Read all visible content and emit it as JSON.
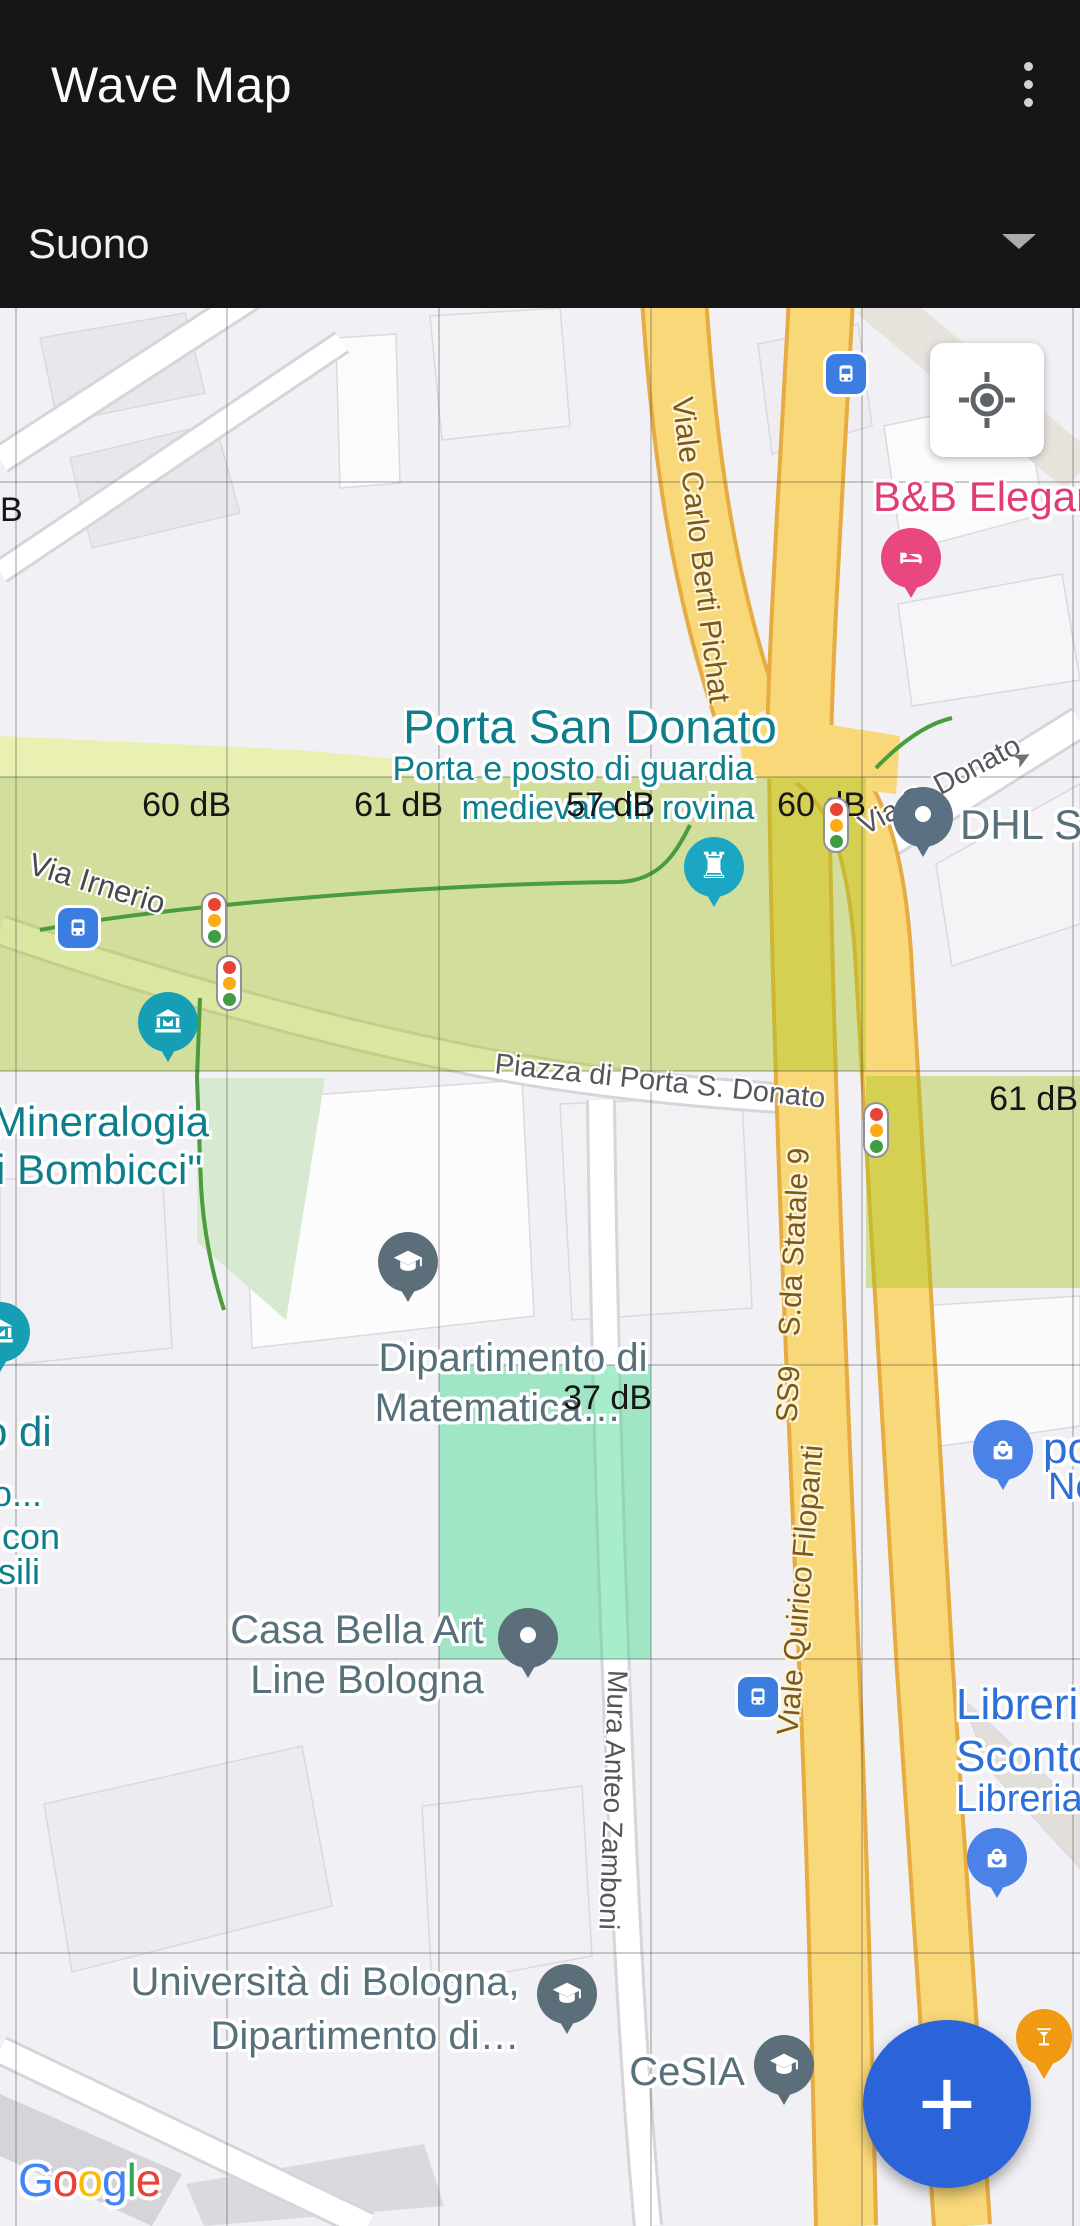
{
  "app_bar": {
    "title": "Wave Map",
    "menu_icon": "kebab-vertical-icon"
  },
  "layer_selector": {
    "value": "Suono",
    "caret_icon": "caret-down-icon",
    "caret_glyph": "▼"
  },
  "map": {
    "type": "google-map",
    "attribution": [
      {
        "ch": "G",
        "color": "#4285F4"
      },
      {
        "ch": "o",
        "color": "#EA4335"
      },
      {
        "ch": "o",
        "color": "#FBBC05"
      },
      {
        "ch": "g",
        "color": "#4285F4"
      },
      {
        "ch": "l",
        "color": "#34A853"
      },
      {
        "ch": "e",
        "color": "#EA4335"
      }
    ],
    "controls": {
      "my_location_icon": "crosshair-icon",
      "fab_icon": "plus-icon",
      "fab_glyph": "+"
    },
    "db_values": [
      60,
      61,
      57,
      60,
      61,
      37
    ],
    "db_labels": [
      {
        "text": "B"
      },
      {
        "text": "60 dB"
      },
      {
        "text": "61 dB"
      },
      {
        "text": "57 dB"
      },
      {
        "text": "60 dB"
      },
      {
        "text": "61 dB"
      },
      {
        "text": "37 dB"
      }
    ],
    "poi_labels": {
      "porta_san_donato": "Porta San Donato",
      "porta_sub_1": "Porta e posto di guardia",
      "porta_sub_2": "medievale in rovina",
      "mineralogia_1": "Mineralogia",
      "mineralogia_2": "i Bombicci\"",
      "museo_cut_1": "o di",
      "museo_cut_2": "o...",
      "museo_cut_3": "con",
      "museo_cut_4": "sili",
      "dhl": "DHL ST",
      "dipartimento_1": "Dipartimento di",
      "dipartimento_2": "Matematica…",
      "casa_1": "Casa Bella Art",
      "casa_2": "Line Bologna",
      "universita_1": "Università di Bologna,",
      "universita_2": "Dipartimento di…",
      "cesia": "CeSIA",
      "bnb": "B&B Elegan",
      "shop_cut_1": "po",
      "shop_cut_2": "Ne",
      "libreria_1": "Libreria",
      "libreria_2": "Sconto",
      "libreria_3": "Libreria"
    },
    "road_labels": {
      "berti_pichat": "Viale Carlo Berti Pichat",
      "via_s_donato": "Via S. Donato",
      "statale": "S.da Statale 9",
      "ss9": "SS9",
      "filopanti": "Viale Quirico Filopanti",
      "zamboni": "Mura Anteo Zamboni",
      "irnerio": "Via Irnerio",
      "piazza": "Piazza di Porta S. Donato"
    },
    "pins": [
      {
        "name": "hotel-pin",
        "icon": "bed-icon",
        "color": "#E8487F"
      },
      {
        "name": "dhl-pin",
        "icon": "dot-pin-icon",
        "color": "#5B7083"
      },
      {
        "name": "porta-tower-pin",
        "icon": "rook-icon",
        "glyph": "♜",
        "color": "#1BA7C4"
      },
      {
        "name": "museum-pin",
        "icon": "museum-icon",
        "color": "#169FB4"
      },
      {
        "name": "museum-pin-partial",
        "icon": "museum-icon",
        "color": "#169FB4"
      },
      {
        "name": "university-pin-matematica",
        "icon": "graduation-cap-icon",
        "color": "#5B6E79"
      },
      {
        "name": "casa-bella-pin",
        "icon": "dot-pin-icon",
        "color": "#5B6E79"
      },
      {
        "name": "shopping-pin",
        "icon": "shopping-bag-icon",
        "color": "#4A82E8"
      },
      {
        "name": "libreria-pin",
        "icon": "shopping-bag-icon",
        "color": "#4A82E8"
      },
      {
        "name": "university-pin-unibo",
        "icon": "graduation-cap-icon",
        "color": "#5B6E79"
      },
      {
        "name": "university-pin-cesia",
        "icon": "graduation-cap-icon",
        "color": "#5B6E79"
      },
      {
        "name": "cocktail-pin",
        "icon": "martini-icon",
        "color": "#F09A14"
      }
    ],
    "colors": {
      "header_bg": "#161616",
      "accent_fab": "#2B63D9",
      "db_cell_yellow": "#DCEA9B",
      "db_cell_mint": "#A8EEC9",
      "poi_teal": "#0E7D8C",
      "poi_slate": "#57707B",
      "poi_blue": "#2F6FD8",
      "poi_pink": "#DF3D74",
      "road_yellow": "#F8D878",
      "road_label_brown": "#7A5A1B"
    }
  }
}
